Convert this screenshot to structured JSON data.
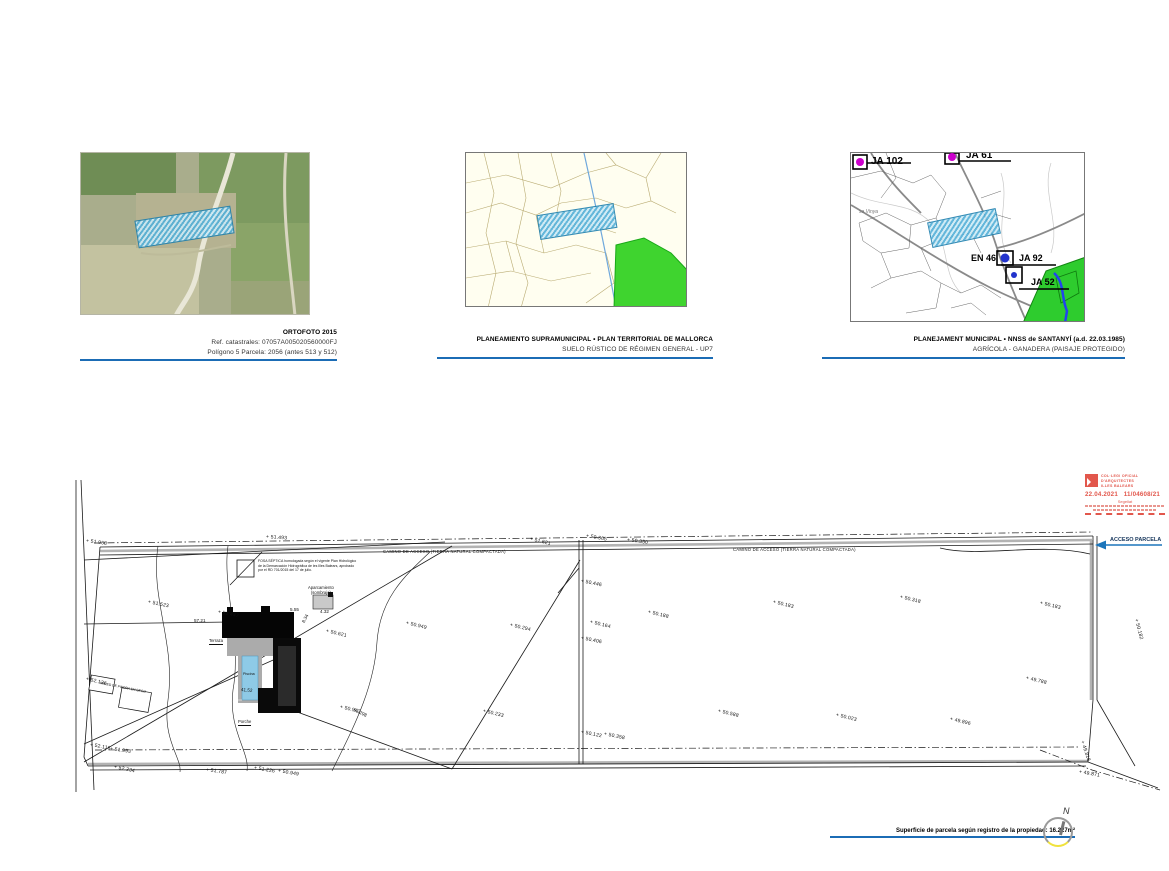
{
  "maps": [
    {
      "title": "ORTOFOTO 2015",
      "line1": "Ref. catastrales: 07057A005020560000FJ",
      "line2": "Polígono 5 Parcela: 2056 (antes 513 y 512)"
    },
    {
      "title": "PLANEAMIENTO SUPRAMUNICIPAL • PLAN TERRITORIAL DE MALLORCA",
      "line2": "SUELO RÚSTICO DE RÉGIMEN GENERAL - UP7"
    },
    {
      "title": "PLANEJAMENT MUNICIPAL • NNSS de SANTANYÍ (a.d. 22.03.1985)",
      "line2": "AGRÍCOLA - GANADERA (PAISAJE PROTEGIDO)"
    }
  ],
  "map3_labels": {
    "ja102": "JA 102",
    "ja61": "JA 61",
    "en46": "EN 46",
    "ja92": "JA 92",
    "ja52": "JA 52",
    "sa_vinya": "sa Vinya"
  },
  "stamp": {
    "org1": "COL·LEGI OFICIAL",
    "org2": "D'ARQUITECTES",
    "org3": "ILLES BALEARS",
    "date": "22.04.2021",
    "number": "11/04608/21",
    "seal": "Segellat"
  },
  "site_plan": {
    "camino_label": "CAMINO DE ACCESO (TIERRA NATURAL COMPACTADA)",
    "acceso_label": "ACCESO PARCELA",
    "fosa_note": "FOSA SÉPTICA homologada según el vigente Plan Hidrológico de la Demarcación Hidrográfica de les Illes Balears, aprobado por el RD 701/2015 del 17 de julio.",
    "labels": {
      "terraza": "Terraza",
      "piscina": "Piscina",
      "porche": "Porche",
      "aparcamiento1": "Aparcamiento",
      "aparcamiento2": "(sombrajo)",
      "pared": "PARED DE PIEDRA EN SECO"
    },
    "area_note": "Superficie de parcela según registro de la propiedad: 16.227m²",
    "north_label": "N",
    "elevations": [
      {
        "t": "+ 51.968",
        "x": 86,
        "y": 538,
        "r": 8
      },
      {
        "t": "+ 51.493",
        "x": 266,
        "y": 534,
        "r": 4
      },
      {
        "t": "+ 51.621",
        "x": 530,
        "y": 536,
        "r": 14
      },
      {
        "t": "+ 50.365",
        "x": 586,
        "y": 533,
        "r": 10
      },
      {
        "t": "+ 50.350",
        "x": 627,
        "y": 537,
        "r": 8
      },
      {
        "t": "+ 50.446",
        "x": 581,
        "y": 578,
        "r": 12
      },
      {
        "t": "+ 50.406",
        "x": 581,
        "y": 635,
        "r": 12
      },
      {
        "t": "+ 50.122",
        "x": 581,
        "y": 729,
        "r": 12
      },
      {
        "t": "+ 50.358",
        "x": 604,
        "y": 731,
        "r": 12
      },
      {
        "t": "+ 51.523",
        "x": 148,
        "y": 599,
        "r": 12
      },
      {
        "t": "+ 51.447",
        "x": 218,
        "y": 609,
        "r": 12
      },
      {
        "t": "+ 50.621",
        "x": 326,
        "y": 628,
        "r": 14
      },
      {
        "t": "+ 50.949",
        "x": 406,
        "y": 620,
        "r": 14
      },
      {
        "t": "+ 50.294",
        "x": 510,
        "y": 622,
        "r": 14
      },
      {
        "t": "+ 50.943",
        "x": 340,
        "y": 704,
        "r": 14
      },
      {
        "t": "+ 50.233",
        "x": 483,
        "y": 708,
        "r": 14
      },
      {
        "t": "+ 50.164",
        "x": 590,
        "y": 619,
        "r": 14
      },
      {
        "t": "+ 50.188",
        "x": 648,
        "y": 609,
        "r": 14
      },
      {
        "t": "+ 50.183",
        "x": 773,
        "y": 599,
        "r": 14
      },
      {
        "t": "+ 50.318",
        "x": 900,
        "y": 594,
        "r": 14
      },
      {
        "t": "+ 50.183",
        "x": 1040,
        "y": 600,
        "r": 14
      },
      {
        "t": "+ 50.182",
        "x": 1136,
        "y": 616,
        "r": 76
      },
      {
        "t": "+ 49.788",
        "x": 1026,
        "y": 675,
        "r": 14
      },
      {
        "t": "+ 49.896",
        "x": 950,
        "y": 716,
        "r": 14
      },
      {
        "t": "+ 50.023",
        "x": 836,
        "y": 712,
        "r": 14
      },
      {
        "t": "+ 50.588",
        "x": 718,
        "y": 708,
        "r": 14
      },
      {
        "t": "+ 49.818",
        "x": 1082,
        "y": 738,
        "r": 72
      },
      {
        "t": "+ 49.871",
        "x": 1079,
        "y": 769,
        "r": 10
      },
      {
        "t": "+ 52.136",
        "x": 86,
        "y": 676,
        "r": 14
      },
      {
        "t": "+ 52.116",
        "x": 90,
        "y": 742,
        "r": 10
      },
      {
        "t": "+ 51.993",
        "x": 110,
        "y": 746,
        "r": 8
      },
      {
        "t": "+ 52.234",
        "x": 114,
        "y": 764,
        "r": 12
      },
      {
        "t": "+ 51.787",
        "x": 206,
        "y": 767,
        "r": 8
      },
      {
        "t": "+ 51.226",
        "x": 254,
        "y": 765,
        "r": 10
      },
      {
        "t": "+ 50.949",
        "x": 278,
        "y": 768,
        "r": 10
      }
    ],
    "dims": [
      {
        "t": "57.21",
        "x": 194,
        "y": 618,
        "r": 0
      },
      {
        "t": "5.55",
        "x": 290,
        "y": 607,
        "r": 0
      },
      {
        "t": "4.32",
        "x": 320,
        "y": 609,
        "r": 0
      },
      {
        "t": "8.34",
        "x": 303,
        "y": 620,
        "r": -62
      },
      {
        "t": "41.52",
        "x": 241,
        "y": 687,
        "r": 5
      },
      {
        "t": "51.298",
        "x": 354,
        "y": 707,
        "r": 26
      }
    ]
  },
  "colors": {
    "underline_blue": "#1b6cb5",
    "stamp_red": "#e2574c",
    "pool_blue": "#8ecae6",
    "hatch_blue": "#54b0d8",
    "zone_green": "#2ecc2e"
  }
}
